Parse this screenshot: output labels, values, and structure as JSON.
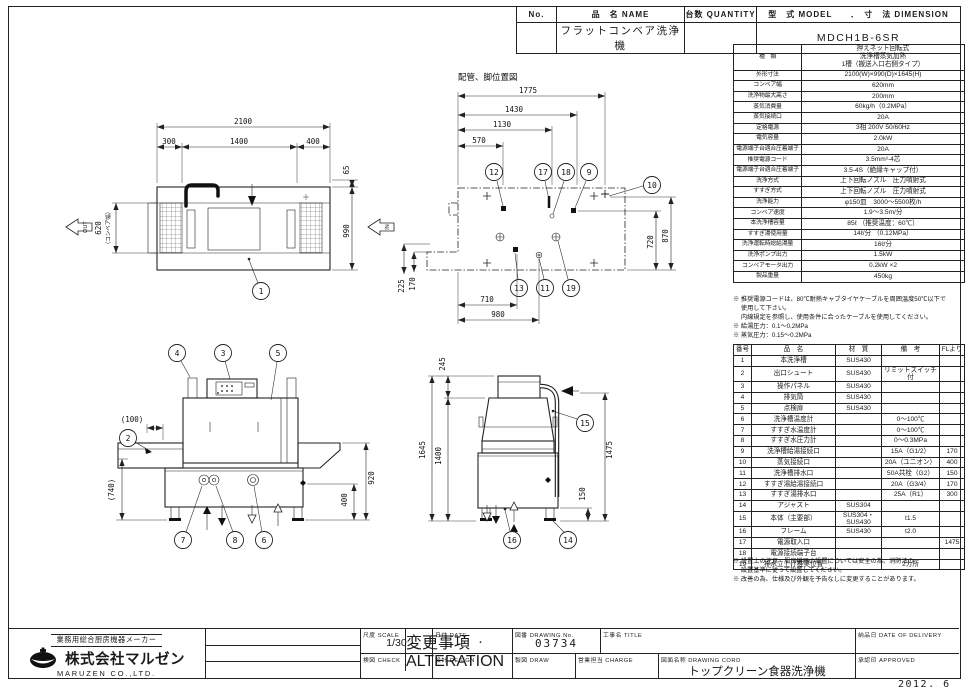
{
  "ink_color": "#222222",
  "header": {
    "no_label": "No.",
    "name_label": "品　名 NAME",
    "name_value": "フラットコンベア洗浄機",
    "qty_label": "台数 QUANTITY",
    "model_label": "型　式 MODEL　　．　寸　法 DIMENSION",
    "model_value": "MDCH1B-6SR"
  },
  "spec": {
    "rows": [
      [
        "種　類",
        "押えネット回転式\n洗浄槽蒸気加熱\n1槽（搬送入口右側タイプ）"
      ],
      [
        "外形寸法",
        "2100(W)×990(D)×1645(H)"
      ],
      [
        "コンベア幅",
        "620mm"
      ],
      [
        "洗浄物最大高さ",
        "200mm"
      ],
      [
        "蒸気消費量",
        "60kg/h（0.2MPa）"
      ],
      [
        "蒸気接続口",
        "20A"
      ],
      [
        "定格電源",
        "3相 200V 50/60Hz"
      ],
      [
        "電気容量",
        "2.0kW"
      ],
      [
        "電源端子台適合圧着端子",
        "20A"
      ],
      [
        "推奨電源コード",
        "3.5mm²-4芯"
      ],
      [
        "電源端子台適合圧着端子",
        "3.5-4S（絶縁キャップ付）"
      ],
      [
        "洗浄方式",
        "上下回転ノズル　圧力噴射式"
      ],
      [
        "すすぎ方式",
        "上下回転ノズル　圧力噴射式"
      ],
      [
        "洗浄能力",
        "φ150皿　3000〜5500枚/h"
      ],
      [
        "コンベア速度",
        "1.9〜3.5m/分"
      ],
      [
        "本洗浄槽容量",
        "85ℓ （推奨温度：60℃）"
      ],
      [
        "すすぎ湯使用量",
        "14ℓ/分 （0.12MPa）"
      ],
      [
        "洗浄運転時総給湯量",
        "16ℓ/分"
      ],
      [
        "洗浄ポンプ出力",
        "1.5kW"
      ],
      [
        "コンベアモータ出力",
        "0.2kW ×2"
      ],
      [
        "製品重量",
        "450kg"
      ]
    ],
    "notes": [
      "※ 推奨電源コードは、80℃耐熱キャブタイヤケーブルを周囲温度50℃以下で",
      "　 使用して下さい。",
      "　 内線規定を参照し、使用条件に合ったケーブルを使用してください。",
      "※ 給湯圧力：0.1〜0.2MPa",
      "※ 蒸気圧力：0.15〜0.2MPa"
    ]
  },
  "parts": {
    "headers": [
      "番号",
      "品　名",
      "材　質",
      "備　考",
      "FLより"
    ],
    "rows": [
      [
        "1",
        "本洗浄槽",
        "SUS430",
        "",
        ""
      ],
      [
        "2",
        "出口シュート",
        "SUS430",
        "リミットスイッチ付",
        ""
      ],
      [
        "3",
        "操作パネル",
        "SUS430",
        "",
        ""
      ],
      [
        "4",
        "排気筒",
        "SUS430",
        "",
        ""
      ],
      [
        "5",
        "点検扉",
        "SUS430",
        "",
        ""
      ],
      [
        "6",
        "洗浄槽温度計",
        "",
        "0〜100℃",
        ""
      ],
      [
        "7",
        "すすぎ水温度計",
        "",
        "0〜100℃",
        ""
      ],
      [
        "8",
        "すすぎ水圧力計",
        "",
        "0〜0.3MPa",
        ""
      ],
      [
        "9",
        "洗浄槽給湯接続口",
        "",
        "15A（G1/2）",
        "170"
      ],
      [
        "10",
        "蒸気接続口",
        "",
        "20A（ユニオン）",
        "400"
      ],
      [
        "11",
        "洗浄槽排水口",
        "",
        "50A共栓（G2）",
        "150"
      ],
      [
        "12",
        "すすぎ湯給湯接続口",
        "",
        "20A（G3/4）",
        "170"
      ],
      [
        "13",
        "すすぎ湯排水口",
        "",
        "25A（R1）",
        "300"
      ],
      [
        "14",
        "アジャスト",
        "SUS304",
        "",
        ""
      ],
      [
        "15",
        "本体（主要部）",
        "SUS304・SUS430",
        "t1.5",
        ""
      ],
      [
        "16",
        "フレーム",
        "SUS430",
        "t2.0",
        ""
      ],
      [
        "17",
        "電源取入口",
        "",
        "",
        "1475"
      ],
      [
        "18",
        "電源接続端子台",
        "",
        "",
        ""
      ],
      [
        "19",
        "排水立上げ推奨位置",
        "",
        "2カ所",
        ""
      ]
    ],
    "notes": [
      "※ 設置上の注意　厨房機器の設置については安全の為、消防法の",
      "　 設置基準に従って設置してください。",
      "※ 改善の為、仕様及び外観を予告なしに変更することがあります。"
    ]
  },
  "title_block": {
    "maker_tagline": "業務用総合厨房機器メーカー",
    "company_jp": "株式会社マルゼン",
    "company_en": "MARUZEN  CO.,LTD.",
    "alteration_label": "変更事項  ALTERATION",
    "scale_label": "尺度  SCALE",
    "scale_value": "1/30",
    "date_label": "日付  DATE",
    "date_value": "・　・",
    "drawing_no_label": "図番  DRAWING No.",
    "drawing_no_value": "03734",
    "title_label": "工事名  TITLE",
    "delivery_label": "納品日  DATE OF DELIVERY",
    "check_label": "検図  CHECK",
    "design_label": "設計  DESIGN",
    "draw_label": "製図  DRAW",
    "charge_label": "営業担当 CHARGE",
    "drawing_name_label": "図面名称  DRAWING CORD",
    "drawing_name_value": "トップクリーン食器洗浄機",
    "approved_label": "承認印  APPROVED",
    "date_stamp": "2012. 6"
  },
  "drawings": {
    "plan": {
      "dim_total_w": "2100",
      "dim_seg_left": "300",
      "dim_seg_mid": "1400",
      "dim_seg_right": "400",
      "dim_offset": "65",
      "dim_depth": "990",
      "dim_belt": "620",
      "dim_belt_note": "（コンベア幅）",
      "out_label": "OUT",
      "in_label": "IN",
      "balloon_1": "1"
    },
    "piping": {
      "title": "配管、脚位置図",
      "dim_1775": "1775",
      "dim_1430": "1430",
      "dim_1130": "1130",
      "dim_570": "570",
      "dim_720": "720",
      "dim_870": "870",
      "dim_225": "225",
      "dim_170": "170",
      "dim_710": "710",
      "dim_980": "980",
      "balloon_12": "12",
      "balloon_17": "17",
      "balloon_18": "18",
      "balloon_9": "9",
      "balloon_10": "10",
      "balloon_13": "13",
      "balloon_11": "11",
      "balloon_19": "19"
    },
    "front": {
      "dim_100": "(100)",
      "dim_740": "(740)",
      "dim_920": "920",
      "dim_400": "400",
      "balloon_4": "4",
      "balloon_3": "3",
      "balloon_5": "5",
      "balloon_2": "2",
      "balloon_7": "7",
      "balloon_8": "8",
      "balloon_6": "6"
    },
    "side": {
      "dim_245": "245",
      "dim_1645": "1645",
      "dim_1400": "1400",
      "dim_1475": "1475",
      "dim_150": "150",
      "balloon_15": "15",
      "balloon_16": "16",
      "balloon_14": "14"
    }
  }
}
